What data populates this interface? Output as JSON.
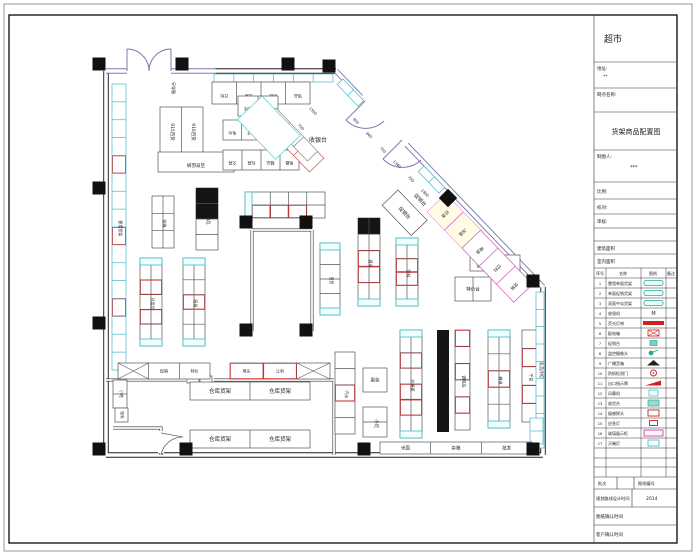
{
  "sheet": {
    "store_title": "超市",
    "address_label": "地址:",
    "address_value": "**",
    "outlet_label": "网点名称:",
    "drawing_title": "货架商品配置图",
    "drafter_label": "制图人:",
    "drafter_value": "***",
    "scale_label": "比例:",
    "check_label": "校对:",
    "review_label": "审核:",
    "building_area_label": "建筑面积",
    "interior_area_label": "室内面积",
    "batch_label": "批次",
    "sheet_no_label": "图纸编号",
    "route_time_label": "规划路线设计时间",
    "route_time_value": "2014",
    "drawing_confirm_label": "图纸确认时间",
    "client_confirm_label": "客户确认时间"
  },
  "legend": {
    "headers": [
      "序号",
      "名称",
      "图例",
      "备注"
    ],
    "rows": [
      {
        "seq": "1",
        "name": "靠墙单面货架",
        "sym": "pill"
      },
      {
        "seq": "2",
        "name": "单面促销货架",
        "sym": "pill"
      },
      {
        "seq": "3",
        "name": "双面中岛货架",
        "sym": "pill"
      },
      {
        "seq": "4",
        "name": "收银机",
        "sym": "M"
      },
      {
        "seq": "5",
        "name": "荧光灯带",
        "sym": "redbar"
      },
      {
        "seq": "6",
        "name": "配电箱",
        "sym": "redxbox"
      },
      {
        "seq": "7",
        "name": "促销台",
        "sym": "tealbox"
      },
      {
        "seq": "8",
        "name": "监控摄像头",
        "sym": "camera"
      },
      {
        "seq": "9",
        "name": "广播音箱",
        "sym": "tri"
      },
      {
        "seq": "10",
        "name": "防损检测门",
        "sym": "redcircle"
      },
      {
        "seq": "11",
        "name": "出口指示牌",
        "sym": "redpara"
      },
      {
        "seq": "12",
        "name": "风幕机",
        "sym": "cyanbox"
      },
      {
        "seq": "13",
        "name": "收货台",
        "sym": "tealbox2"
      },
      {
        "seq": "14",
        "name": "烟感探头",
        "sym": "redobox"
      },
      {
        "seq": "15",
        "name": "应急灯",
        "sym": "redobox2"
      },
      {
        "seq": "16",
        "name": "玻璃展示柜",
        "sym": "magbox"
      },
      {
        "seq": "17",
        "name": "灭蝇灯",
        "sym": "cyanobox"
      }
    ]
  },
  "plan": {
    "labels": [
      {
        "t": "收银台",
        "x": 318,
        "y": 142,
        "r": 0,
        "c": "#cc3333",
        "s": 6
      },
      {
        "t": "服务台",
        "x": 175,
        "y": 88,
        "r": -90,
        "c": "#333",
        "s": 4
      },
      {
        "t": "915百货",
        "x": 171,
        "y": 132,
        "r": 90,
        "c": "#333",
        "s": 4.5
      },
      {
        "t": "916百货",
        "x": 192,
        "y": 132,
        "r": 90,
        "c": "#333",
        "s": 4.5
      },
      {
        "t": "促销台",
        "x": 419,
        "y": 201,
        "r": 46,
        "c": "#aa3344",
        "s": 5
      },
      {
        "t": "小吃",
        "x": 120,
        "y": 394,
        "r": 90,
        "c": "#333",
        "s": 4
      },
      {
        "t": "配电",
        "x": 121,
        "y": 415,
        "r": 90,
        "c": "#333",
        "s": 3.5
      },
      {
        "t": "乳品冷柜",
        "x": 540,
        "y": 370,
        "r": 90,
        "c": "#333",
        "s": 4
      }
    ],
    "dims": [
      {
        "t": "1500",
        "x": 312,
        "y": 112
      },
      {
        "t": "750",
        "x": 300,
        "y": 128
      },
      {
        "t": "950",
        "x": 355,
        "y": 122
      },
      {
        "t": "940",
        "x": 368,
        "y": 136
      },
      {
        "t": "750",
        "x": 382,
        "y": 151
      },
      {
        "t": "1340",
        "x": 396,
        "y": 165
      },
      {
        "t": "750",
        "x": 410,
        "y": 180
      },
      {
        "t": "1800",
        "x": 424,
        "y": 194
      }
    ],
    "columns": [
      [
        99,
        64
      ],
      [
        182,
        64
      ],
      [
        288,
        64
      ],
      [
        329,
        66
      ],
      [
        99,
        188
      ],
      [
        99,
        323
      ],
      [
        99,
        449
      ],
      [
        186,
        449
      ],
      [
        364,
        449
      ],
      [
        533,
        449
      ],
      [
        246,
        222
      ],
      [
        306,
        222
      ],
      [
        246,
        330
      ],
      [
        306,
        330
      ],
      [
        533,
        281
      ]
    ],
    "diamond": [
      448,
      198
    ],
    "solids": [
      {
        "x": 437,
        "y": 330,
        "w": 12,
        "h": 102
      }
    ],
    "shelves": [
      {
        "x": 112,
        "y": 84,
        "w": 14,
        "h": 286,
        "dir": "v",
        "cells": 16,
        "cols": 1,
        "stroke": "#45b8c8",
        "red": [
          4,
          8,
          12
        ],
        "label": {
          "t": "靠墙货架",
          "r": 90,
          "s": 4
        }
      },
      {
        "x": 214,
        "y": 74,
        "w": 119,
        "h": 8,
        "dir": "h",
        "cells": 6,
        "stroke": "#45b8c8"
      },
      {
        "x": 212,
        "y": 82,
        "w": 98,
        "h": 22,
        "dir": "h",
        "cells": 4,
        "cellLabels": [
          "日化",
          "洗涤",
          "化妆",
          "饰品"
        ],
        "clr": 180,
        "cls": 4
      },
      {
        "x": 160,
        "y": 107,
        "w": 43,
        "h": 48,
        "dir": "v",
        "cells": 1,
        "cols": 2
      },
      {
        "x": 158,
        "y": 152,
        "w": 76,
        "h": 20,
        "dir": "h",
        "cells": 1,
        "label": {
          "t": "百货促销",
          "r": 180,
          "s": 4.5
        }
      },
      {
        "x": 238,
        "y": 96,
        "w": 40,
        "h": 20,
        "dir": "h",
        "cells": 2,
        "cellLabels": [
          "洗化",
          "纸品"
        ],
        "clr": 180,
        "cls": 4
      },
      {
        "x": 223,
        "y": 120,
        "w": 56,
        "h": 20,
        "dir": "h",
        "cells": 3,
        "cellLabels": [
          "毛巾",
          "袜子",
          "内衣"
        ],
        "clr": 180,
        "cls": 4
      },
      {
        "x": 223,
        "y": 150,
        "w": 76,
        "h": 20,
        "dir": "h",
        "cells": 4,
        "cellLabels": [
          "文具",
          "玩具",
          "精品",
          "电器"
        ],
        "clr": 180,
        "cls": 4
      },
      {
        "x": 152,
        "y": 196,
        "w": 22,
        "h": 52,
        "dir": "v",
        "cells": 3,
        "cols": 2,
        "label": {
          "t": "挂饰",
          "r": 90,
          "s": 4
        }
      },
      {
        "x": 196,
        "y": 188,
        "w": 22,
        "h": 62,
        "dir": "v",
        "cells": 4,
        "cols": 1,
        "black": [
          0,
          1
        ],
        "label": {
          "t": "饰品",
          "r": 90,
          "s": 4
        }
      },
      {
        "x": 140,
        "y": 258,
        "w": 22,
        "h": 88,
        "dir": "v",
        "cells": 5,
        "cols": 2,
        "cap": "both",
        "red": [
          1,
          3
        ],
        "label": {
          "t": "日用品",
          "r": 90,
          "s": 4
        }
      },
      {
        "x": 183,
        "y": 258,
        "w": 22,
        "h": 88,
        "dir": "v",
        "cells": 5,
        "cols": 2,
        "cap": "both",
        "red": [
          2
        ],
        "label": {
          "t": "厨具",
          "r": 90,
          "s": 4
        }
      },
      {
        "x": 245,
        "y": 192,
        "w": 80,
        "h": 26,
        "dir": "h",
        "cells": 4,
        "cols": 2,
        "cap": "top",
        "red": [
          4,
          5,
          6
        ]
      },
      {
        "x": 358,
        "y": 218,
        "w": 22,
        "h": 88,
        "dir": "v",
        "cells": 5,
        "cols": 2,
        "cap": "bot",
        "black": [
          0
        ],
        "red": [
          2,
          3
        ],
        "label": {
          "t": "酒水",
          "r": 90,
          "s": 4
        }
      },
      {
        "x": 396,
        "y": 238,
        "w": 22,
        "h": 68,
        "dir": "v",
        "cells": 4,
        "cols": 2,
        "cap": "both",
        "red": [
          1,
          2
        ],
        "label": {
          "t": "饮料",
          "r": 90,
          "s": 4
        }
      },
      {
        "x": 320,
        "y": 243,
        "w": 20,
        "h": 72,
        "dir": "v",
        "cells": 4,
        "cols": 1,
        "cap": "both",
        "label": {
          "t": "百货",
          "r": 90,
          "s": 4
        }
      },
      {
        "x": 455,
        "y": 277,
        "w": 36,
        "h": 24,
        "dir": "h",
        "cells": 2,
        "label": {
          "t": "特价台",
          "s": 4.5
        }
      },
      {
        "x": 470,
        "y": 255,
        "w": 50,
        "h": 16,
        "dir": "h",
        "cells": 2,
        "cellLabels": [
          "小家电",
          "挂钩"
        ],
        "clr": 180,
        "cls": 4
      },
      {
        "x": 335,
        "y": 352,
        "w": 20,
        "h": 82,
        "dir": "v",
        "cells": 5,
        "cols": 1,
        "red": [
          2
        ],
        "label": {
          "t": "汽水",
          "r": 90,
          "s": 4
        }
      },
      {
        "x": 363,
        "y": 368,
        "w": 24,
        "h": 24,
        "dir": "h",
        "cells": 1,
        "label": {
          "t": "服装",
          "s": 4.5
        }
      },
      {
        "x": 363,
        "y": 407,
        "w": 24,
        "h": 30,
        "dir": "v",
        "cells": 2,
        "cols": 1,
        "label": {
          "t": "小吃",
          "r": 90,
          "s": 4.5
        }
      },
      {
        "x": 400,
        "y": 330,
        "w": 22,
        "h": 108,
        "dir": "v",
        "cells": 6,
        "cols": 2,
        "cap": "both",
        "red": [
          1,
          3,
          4
        ],
        "label": {
          "t": "方便面",
          "r": 90,
          "s": 4
        }
      },
      {
        "x": 455,
        "y": 330,
        "w": 15,
        "h": 100,
        "dir": "v",
        "cells": 6,
        "cols": 1,
        "red": [
          0,
          2,
          4
        ],
        "label": {
          "t": "调味品",
          "r": 90,
          "s": 4
        }
      },
      {
        "x": 488,
        "y": 330,
        "w": 22,
        "h": 98,
        "dir": "v",
        "cells": 5,
        "cols": 2,
        "cap": "both",
        "red": [
          2
        ],
        "label": {
          "t": "粮油",
          "r": 90,
          "s": 4
        }
      },
      {
        "x": 522,
        "y": 330,
        "w": 15,
        "h": 92,
        "dir": "v",
        "cells": 5,
        "cols": 1,
        "red": [
          1,
          3
        ],
        "label": {
          "t": "干货",
          "r": 90,
          "s": 4
        }
      },
      {
        "x": 536,
        "y": 292,
        "w": 8,
        "h": 156,
        "dir": "v",
        "cells": 9,
        "cols": 1,
        "stroke": "#45b8c8"
      },
      {
        "x": 530,
        "y": 418,
        "w": 13,
        "h": 26,
        "dir": "v",
        "cells": 2,
        "cols": 1,
        "stroke": "#45b8c8"
      },
      {
        "x": 380,
        "y": 442,
        "w": 152,
        "h": 12,
        "dir": "h",
        "cells": 3,
        "cellLabels": [
          "米面",
          "杂粮",
          "批发"
        ],
        "clr": 0,
        "cls": 4.5
      },
      {
        "x": 118,
        "y": 363,
        "w": 92,
        "h": 16,
        "dir": "h",
        "cells": 3,
        "xcells": [
          0
        ],
        "cellLabels": [
          "",
          "促销",
          "特价"
        ],
        "clr": 0,
        "cls": 4
      },
      {
        "x": 230,
        "y": 363,
        "w": 100,
        "h": 16,
        "dir": "h",
        "cells": 3,
        "xcells": [
          2
        ],
        "red": [
          0,
          1
        ],
        "cellLabels": [
          "堆头",
          "让利",
          ""
        ],
        "clr": 0,
        "cls": 4
      },
      {
        "x": 190,
        "y": 382,
        "w": 120,
        "h": 18,
        "dir": "h",
        "cells": 2,
        "cellLabels": [
          "仓库货架",
          "仓库货架"
        ],
        "clr": 0,
        "cls": 5.5
      },
      {
        "x": 190,
        "y": 430,
        "w": 120,
        "h": 18,
        "dir": "h",
        "cells": 2,
        "cellLabels": [
          "仓库货架",
          "仓库货架"
        ],
        "clr": 0,
        "cls": 5.5
      },
      {
        "x": 113,
        "y": 380,
        "w": 14,
        "h": 28,
        "dir": "v",
        "cells": 2,
        "cols": 1
      },
      {
        "x": 115,
        "y": 408,
        "w": 13,
        "h": 14,
        "dir": "v",
        "cells": 1,
        "cols": 1
      },
      {
        "x": 343,
        "y": 79,
        "r": 46.2,
        "w": 30,
        "h": 8,
        "dir": "h",
        "cells": 2,
        "stroke": "#45b8c8"
      },
      {
        "x": 424,
        "y": 166,
        "r": 46.2,
        "w": 30,
        "h": 8,
        "dir": "h",
        "cells": 2,
        "stroke": "#45b8c8"
      },
      {
        "x": 446,
        "y": 194,
        "r": 46.2,
        "w": 125,
        "h": 26,
        "dir": "h",
        "cells": 5,
        "stroke": "#cc55bb",
        "fills": [
          0,
          1
        ],
        "fillColor": "#fffbe4",
        "cellLabels": [
          "红酒",
          "洋酒",
          "啤酒",
          "饮料",
          "促销"
        ],
        "clr": 90,
        "cls": 4.2,
        "lc": "#cc44aa"
      },
      {
        "x": 292,
        "y": 125,
        "r": 46.2,
        "w": 46,
        "h": 20,
        "dir": "h",
        "cells": 2,
        "stroke": "#cc5555"
      },
      {
        "x": 276,
        "y": 108,
        "r": 46.2,
        "w": 60,
        "h": 14,
        "dir": "h",
        "cells": 3,
        "stroke": "#888"
      },
      {
        "x": 262,
        "y": 96,
        "r": 46.2,
        "w": 55,
        "h": 34,
        "dir": "h",
        "cells": 1,
        "stroke": "#55cccc"
      },
      {
        "x": 398,
        "y": 190,
        "r": 46.2,
        "w": 42,
        "h": 22,
        "dir": "h",
        "cells": 1,
        "label": {
          "t": "促销台",
          "c": "#aa3344",
          "s": 5
        }
      }
    ]
  }
}
